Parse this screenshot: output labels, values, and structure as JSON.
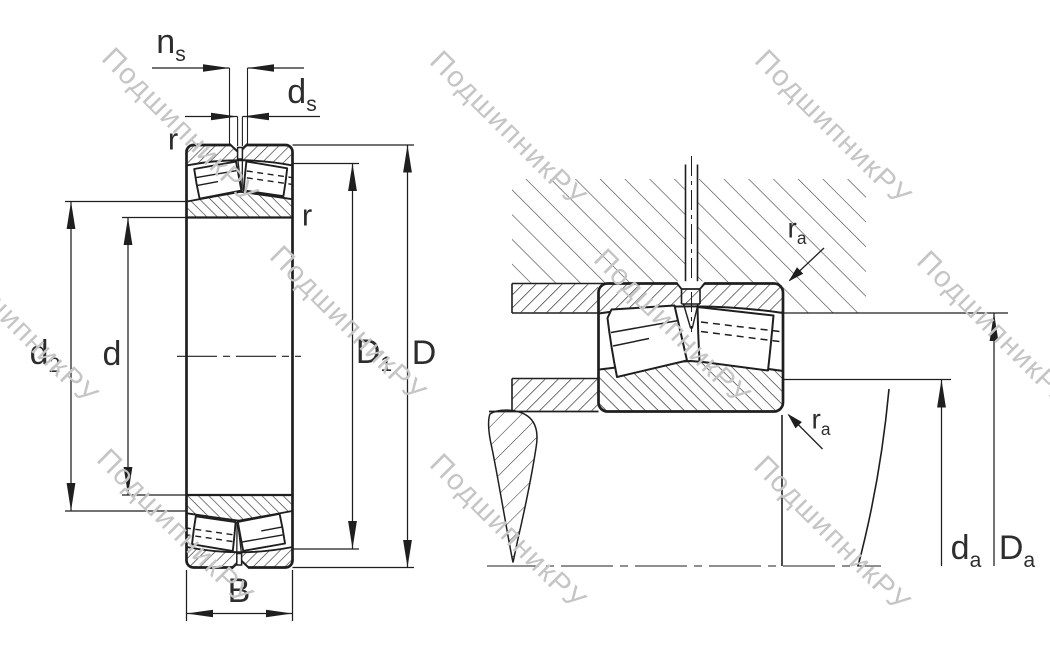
{
  "page": {
    "background": "#ffffff"
  },
  "drawing": {
    "line_color": "#1f1f1f",
    "hatch_color": "#333333",
    "label_color": "#2d2d2d",
    "views": {
      "left": "bearing cross-section with dimensions",
      "right": "bearing mounted in housing and shaft"
    }
  },
  "watermark": {
    "text": "ПодшипникРУ",
    "color": "#c5c5c5",
    "rotation_deg": 45,
    "positions": [
      {
        "x": 118,
        "y": 42
      },
      {
        "x": 446,
        "y": 45
      },
      {
        "x": 771,
        "y": 44
      },
      {
        "x": -42,
        "y": 243
      },
      {
        "x": 286,
        "y": 240
      },
      {
        "x": 610,
        "y": 243
      },
      {
        "x": 933,
        "y": 245
      },
      {
        "x": 113,
        "y": 443
      },
      {
        "x": 446,
        "y": 448
      },
      {
        "x": 770,
        "y": 450
      }
    ]
  },
  "labels": {
    "ns": {
      "main": "n",
      "sub": "s"
    },
    "ds": {
      "main": "d",
      "sub": "s"
    },
    "r_outer": {
      "main": "r",
      "sub": ""
    },
    "r_inner": {
      "main": "r",
      "sub": ""
    },
    "d2": {
      "main": "d",
      "sub": "2"
    },
    "d": {
      "main": "d",
      "sub": ""
    },
    "D1": {
      "main": "D",
      "sub": "1"
    },
    "D": {
      "main": "D",
      "sub": ""
    },
    "B": {
      "main": "B",
      "sub": ""
    },
    "ra_top": {
      "main": "r",
      "sub": "a"
    },
    "ra_bottom": {
      "main": "r",
      "sub": "a"
    },
    "da": {
      "main": "d",
      "sub": "a"
    },
    "Da": {
      "main": "D",
      "sub": "a"
    }
  }
}
